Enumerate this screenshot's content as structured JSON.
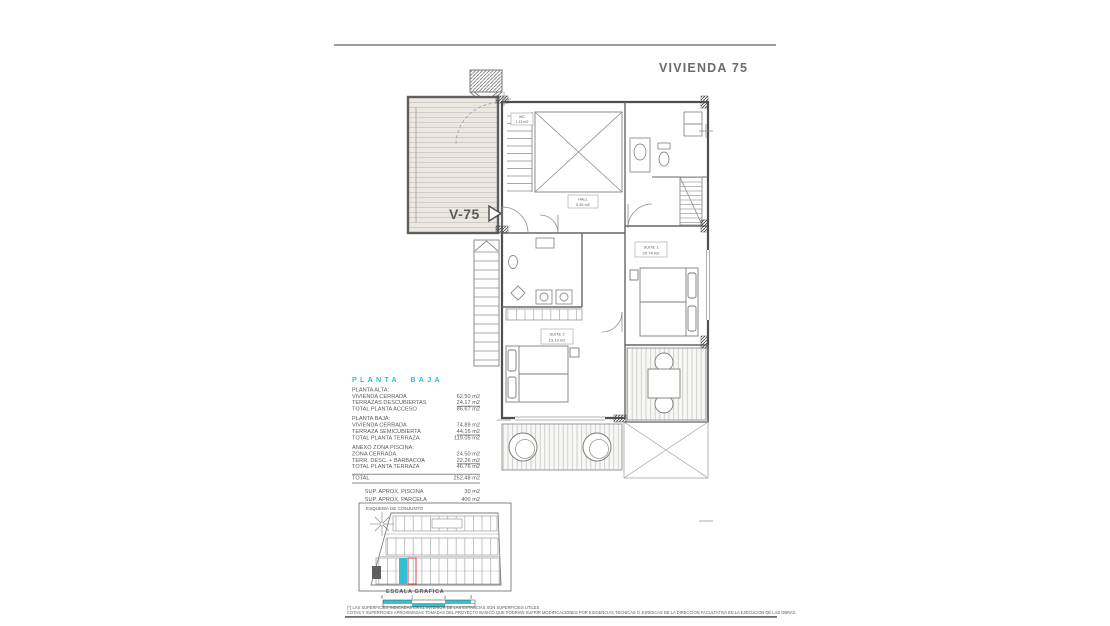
{
  "title": "VIVIENDA 75",
  "plan": {
    "unit_label": "V-75",
    "rooms": [
      {
        "name": "WC",
        "area": "1.11 m2"
      },
      {
        "name": "HALL",
        "area": "5.35 m2"
      },
      {
        "name": "SUITE 1",
        "area": "20.74 m2"
      },
      {
        "name": "SUITE 2",
        "area": "13.19 m2"
      }
    ]
  },
  "surface_table": {
    "heading": "PLANTA BAJA",
    "sections": [
      {
        "title": "PLANTA ALTA:",
        "rows": [
          {
            "label": "VIVIENDA CERRADA",
            "value": "62.50 m2"
          },
          {
            "label": "TERRAZAS DESCUBIERTAS",
            "value": "24.17 m2"
          },
          {
            "label": "TOTAL PLANTA ACCESO",
            "value": "86.67 m2"
          }
        ]
      },
      {
        "title": "PLANTA BAJA:",
        "rows": [
          {
            "label": "VIVIENDA CERRADA",
            "value": "74.89 m2"
          },
          {
            "label": "TERRAZA SEMICUBIERTA",
            "value": "44.16 m2"
          },
          {
            "label": "TOTAL PLANTA TERRAZA",
            "value": "119.05 m2"
          }
        ]
      },
      {
        "title": "ANEXO ZONA PISCINA:",
        "rows": [
          {
            "label": "ZONA CERRADA",
            "value": "24.50 m2"
          },
          {
            "label": "TERR. DESC. + BARBACOA",
            "value": "22.26 m2"
          },
          {
            "label": "TOTAL PLANTA TERRAZA",
            "value": "46.76 m2"
          }
        ]
      }
    ],
    "total": {
      "label": "TOTAL",
      "value": "252.48 m2"
    },
    "extras": [
      {
        "label": "SUP. APROX. PISCINA",
        "value": "30 m2"
      },
      {
        "label": "SUP. APROX. PARCELA",
        "value": "400 m2"
      }
    ]
  },
  "site_plan": {
    "title": "ESQUEMA DE CONJUNTO"
  },
  "scale": {
    "label": "ESCALA GRAFICA",
    "ticks": [
      "0",
      "1",
      "2",
      "3"
    ]
  },
  "footnotes": [
    "(*) LAS SUPERFICIES INDICADAS EN EL INTERIOR DE LAS ESTANCIAS SON SUPERFICIES UTILES",
    "COTAS Y SUPERFICIES APROXIMADAS TOMADAS DEL PROYECTO BASICO QUE PODRIAN SUFRIR MODIFICACIONES POR EXIGENCIAS TECNICAS O JURIDICAS DE LA DIRECCION FACULTATIVA EN LA EJECUCION DE LAS OBRAS"
  ],
  "colors": {
    "accent": "#2fbdd1",
    "plot_highlight": "#35bfd2",
    "plot_outline_red": "#e0524e"
  }
}
